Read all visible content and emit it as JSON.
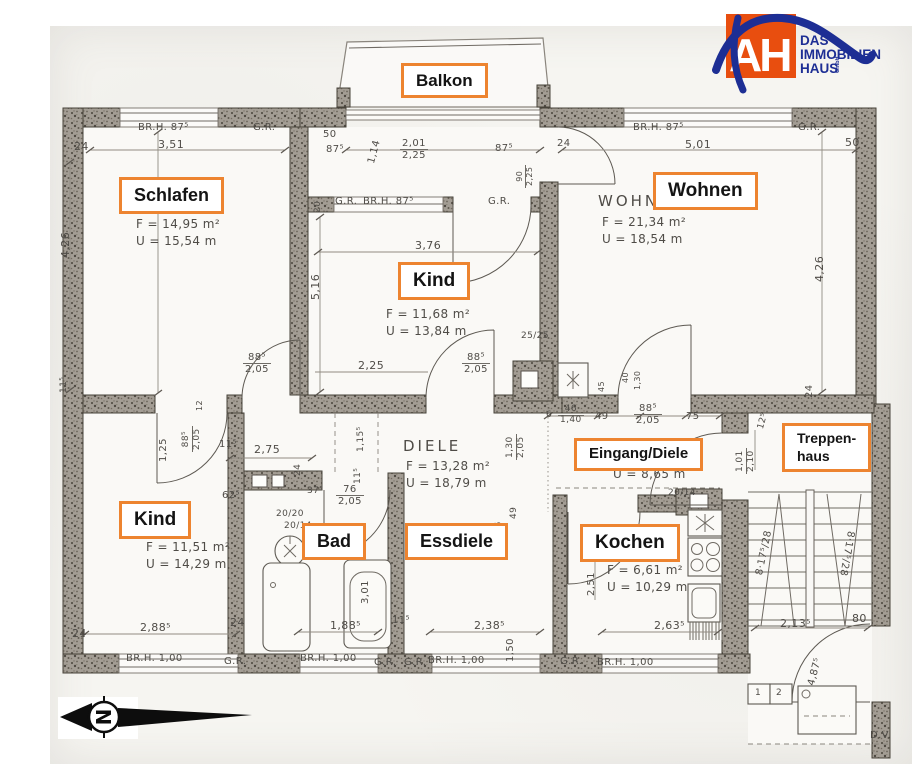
{
  "colors": {
    "label_border": "#ed8430",
    "logo_orange": "#e84e0f",
    "logo_blue": "#1d2e94",
    "pencil": "#4f4c47"
  },
  "logo": {
    "ah": "AH",
    "line1": "DAS",
    "line2": "IMMOBILIEN",
    "line3": "HAUS",
    "line4": "GmbH"
  },
  "compass": {
    "letter": "N"
  },
  "footer_note": "D.V.",
  "room_labels": [
    {
      "t": "Balkon",
      "x": 401,
      "y": 63,
      "fs": 17
    },
    {
      "t": "Schlafen",
      "x": 119,
      "y": 177,
      "fs": 18
    },
    {
      "t": "Wohnen",
      "x": 653,
      "y": 172,
      "fs": 19
    },
    {
      "t": "Kind",
      "x": 398,
      "y": 262,
      "fs": 19
    },
    {
      "t": "Kind",
      "x": 119,
      "y": 501,
      "fs": 19
    },
    {
      "t": "Bad",
      "x": 302,
      "y": 523,
      "fs": 18
    },
    {
      "t": "Essdiele",
      "x": 405,
      "y": 523,
      "fs": 18
    },
    {
      "t": "Kochen",
      "x": 580,
      "y": 524,
      "fs": 19
    },
    {
      "t": "Eingang/Diele",
      "x": 574,
      "y": 438,
      "fs": 15
    },
    {
      "t": "Treppen-",
      "t2": "haus",
      "x": 782,
      "y": 423,
      "fs": 14
    }
  ],
  "annotations": [
    {
      "t": "24",
      "x": 74,
      "y": 141
    },
    {
      "t": "3,51",
      "x": 158,
      "y": 139
    },
    {
      "t": "BR.H. 87⁵",
      "x": 138,
      "y": 122,
      "fs": 10
    },
    {
      "t": "G.R.",
      "x": 253,
      "y": 122,
      "fs": 10
    },
    {
      "t": "50",
      "x": 323,
      "y": 129,
      "fs": 10
    },
    {
      "t": "87⁵",
      "x": 326,
      "y": 144,
      "fs": 10
    },
    {
      "t": "1,14",
      "x": 366,
      "y": 162,
      "rot": -75,
      "fs": 10
    },
    {
      "t": "2,01",
      "t2": "2,25",
      "x": 400,
      "y": 138,
      "fs": 10
    },
    {
      "t": "87⁵",
      "x": 495,
      "y": 143,
      "fs": 10
    },
    {
      "t": "24",
      "x": 557,
      "y": 138,
      "fs": 10
    },
    {
      "t": "90",
      "t2": "2,25",
      "x": 516,
      "y": 188,
      "rot": -90,
      "fs": 8
    },
    {
      "t": "BR.H. 87⁵",
      "x": 633,
      "y": 122,
      "fs": 10
    },
    {
      "t": "5,01",
      "x": 685,
      "y": 139
    },
    {
      "t": "G.R.",
      "x": 798,
      "y": 122,
      "fs": 10
    },
    {
      "t": "50",
      "x": 845,
      "y": 137
    },
    {
      "t": "20",
      "x": 314,
      "y": 213,
      "rot": -90,
      "fs": 9
    },
    {
      "t": "G.R.",
      "x": 335,
      "y": 196,
      "fs": 10
    },
    {
      "t": "BR.H. 87⁵",
      "x": 363,
      "y": 196,
      "fs": 10
    },
    {
      "t": "G.R.",
      "x": 488,
      "y": 196,
      "fs": 10
    },
    {
      "t": "WOHNZ",
      "x": 598,
      "y": 193,
      "fs": 15,
      "sp": 3
    },
    {
      "t": "F = 21,34 m²",
      "x": 602,
      "y": 216,
      "fs": 12
    },
    {
      "t": "U = 18,54 m",
      "x": 602,
      "y": 233,
      "fs": 12
    },
    {
      "t": "F = 14,95 m²",
      "x": 136,
      "y": 218,
      "fs": 12
    },
    {
      "t": "U = 15,54 m",
      "x": 136,
      "y": 235,
      "fs": 12
    },
    {
      "t": "4,26",
      "x": 60,
      "y": 258,
      "rot": -90
    },
    {
      "t": "4,26",
      "x": 814,
      "y": 282,
      "rot": -90
    },
    {
      "t": "5,16",
      "x": 310,
      "y": 300,
      "rot": -90
    },
    {
      "t": "3,76",
      "x": 415,
      "y": 240
    },
    {
      "t": "F = 11,68 m²",
      "x": 386,
      "y": 308,
      "fs": 12
    },
    {
      "t": "U = 13,84 m",
      "x": 386,
      "y": 325,
      "fs": 12
    },
    {
      "t": "24",
      "x": 804,
      "y": 398,
      "rot": -90,
      "fs": 10
    },
    {
      "t": "11⁵",
      "x": 60,
      "y": 393,
      "rot": -90,
      "fs": 9
    },
    {
      "t": "88⁵",
      "t2": "2,05",
      "x": 243,
      "y": 352,
      "fs": 10
    },
    {
      "t": "2,25",
      "x": 358,
      "y": 360,
      "fs": 11
    },
    {
      "t": "88⁵",
      "t2": "2,05",
      "x": 462,
      "y": 352,
      "fs": 10
    },
    {
      "t": "25/25",
      "x": 521,
      "y": 332,
      "fs": 9
    },
    {
      "t": "45",
      "x": 598,
      "y": 392,
      "rot": -90,
      "fs": 8
    },
    {
      "t": "40",
      "x": 622,
      "y": 383,
      "rot": -90,
      "fs": 8
    },
    {
      "t": "1,30",
      "x": 634,
      "y": 390,
      "rot": -90,
      "fs": 8
    },
    {
      "t": "88⁵",
      "t2": "2,05",
      "x": 182,
      "y": 452,
      "rot": -90,
      "fs": 9
    },
    {
      "t": "1,25",
      "x": 158,
      "y": 462,
      "rot": -90,
      "fs": 10
    },
    {
      "t": "12",
      "x": 196,
      "y": 411,
      "rot": -90,
      "fs": 8
    },
    {
      "t": "11⁵",
      "x": 219,
      "y": 439,
      "fs": 10
    },
    {
      "t": "2,75",
      "x": 254,
      "y": 444,
      "fs": 11
    },
    {
      "t": "24",
      "x": 294,
      "y": 476,
      "rot": -90,
      "fs": 9
    },
    {
      "t": "1,15⁵",
      "x": 357,
      "y": 452,
      "rot": -90,
      "fs": 9
    },
    {
      "t": "11⁵",
      "x": 354,
      "y": 484,
      "rot": -90,
      "fs": 9
    },
    {
      "t": "DIELE",
      "x": 403,
      "y": 438,
      "fs": 15,
      "sp": 3
    },
    {
      "t": "F = 13,28 m²",
      "x": 406,
      "y": 460,
      "fs": 12
    },
    {
      "t": "U = 18,79 m",
      "x": 406,
      "y": 477,
      "fs": 12
    },
    {
      "t": "1,30",
      "t2": "2,05",
      "x": 506,
      "y": 460,
      "rot": -90,
      "fs": 9
    },
    {
      "t": "6",
      "x": 546,
      "y": 411,
      "fs": 9
    },
    {
      "t": "46",
      "t2": "1,40",
      "x": 558,
      "y": 405,
      "fs": 9
    },
    {
      "t": "49",
      "x": 595,
      "y": 411,
      "fs": 10
    },
    {
      "t": "88⁵",
      "t2": "2,05",
      "x": 634,
      "y": 403,
      "fs": 10
    },
    {
      "t": "75",
      "x": 686,
      "y": 411,
      "fs": 10
    },
    {
      "t": "U = 8,65 m",
      "x": 613,
      "y": 468,
      "fs": 12
    },
    {
      "t": "12⁵",
      "x": 757,
      "y": 428,
      "rot": -75,
      "fs": 9
    },
    {
      "t": "1,01",
      "t2": "2,10",
      "x": 736,
      "y": 474,
      "rot": -90,
      "fs": 9
    },
    {
      "t": "49",
      "x": 510,
      "y": 519,
      "rot": -90,
      "fs": 9
    },
    {
      "t": "2,26",
      "x": 495,
      "y": 543,
      "rot": -90,
      "fs": 9
    },
    {
      "t": "20/14",
      "x": 668,
      "y": 489,
      "fs": 9
    },
    {
      "t": "20/20",
      "x": 276,
      "y": 510,
      "fs": 9
    },
    {
      "t": "20/14",
      "x": 284,
      "y": 522,
      "fs": 9
    },
    {
      "t": "37⁵",
      "x": 307,
      "y": 487,
      "fs": 9
    },
    {
      "t": "76",
      "t2": "2,05",
      "x": 336,
      "y": 484,
      "fs": 10
    },
    {
      "t": "62⁵",
      "x": 222,
      "y": 490,
      "fs": 10
    },
    {
      "t": "F = 11,51 m²",
      "x": 146,
      "y": 541,
      "fs": 12
    },
    {
      "t": "U = 14,29 m",
      "x": 146,
      "y": 558,
      "fs": 12
    },
    {
      "t": "3,01",
      "x": 360,
      "y": 604,
      "rot": -90,
      "fs": 10
    },
    {
      "t": "F = 6,61 m²",
      "x": 607,
      "y": 564,
      "fs": 12
    },
    {
      "t": "U = 10,29 m",
      "x": 607,
      "y": 581,
      "fs": 12
    },
    {
      "t": "2,51",
      "x": 586,
      "y": 596,
      "rot": -90,
      "fs": 10
    },
    {
      "t": "8·17⁵/28",
      "x": 754,
      "y": 574,
      "rot": -78,
      "fs": 10
    },
    {
      "t": "8·17⁵/28",
      "x": 856,
      "y": 532,
      "rot": 100,
      "fs": 10
    },
    {
      "t": "24",
      "x": 72,
      "y": 628
    },
    {
      "t": "2,88⁵",
      "x": 140,
      "y": 622
    },
    {
      "t": "24",
      "x": 230,
      "y": 617
    },
    {
      "t": "BR.H. 1,00",
      "x": 126,
      "y": 653,
      "fs": 10
    },
    {
      "t": "G.R.",
      "x": 224,
      "y": 656,
      "fs": 10
    },
    {
      "t": "1,88⁵",
      "x": 330,
      "y": 620
    },
    {
      "t": "BR.H. 1,00",
      "x": 300,
      "y": 653,
      "fs": 10
    },
    {
      "t": "G.R.",
      "x": 374,
      "y": 657,
      "fs": 10
    },
    {
      "t": "11⁵",
      "x": 392,
      "y": 615,
      "fs": 10
    },
    {
      "t": "G.R.",
      "x": 404,
      "y": 657,
      "fs": 10
    },
    {
      "t": "BR.H. 1,00",
      "x": 428,
      "y": 655,
      "fs": 10
    },
    {
      "t": "2,38⁵",
      "x": 474,
      "y": 620
    },
    {
      "t": "1,50",
      "x": 505,
      "y": 662,
      "rot": -90,
      "fs": 10
    },
    {
      "t": "G.R.",
      "x": 560,
      "y": 656,
      "fs": 10
    },
    {
      "t": "BR.H. 1,00",
      "x": 597,
      "y": 657,
      "fs": 10
    },
    {
      "t": "2,63⁵",
      "x": 654,
      "y": 620
    },
    {
      "t": "2,13⁵",
      "x": 780,
      "y": 618
    },
    {
      "t": "80",
      "x": 852,
      "y": 613
    },
    {
      "t": "4,87⁵",
      "x": 806,
      "y": 684,
      "rot": -75,
      "fs": 10
    },
    {
      "t": "1",
      "x": 755,
      "y": 689,
      "fs": 9
    },
    {
      "t": "2",
      "x": 776,
      "y": 689,
      "fs": 9
    }
  ]
}
